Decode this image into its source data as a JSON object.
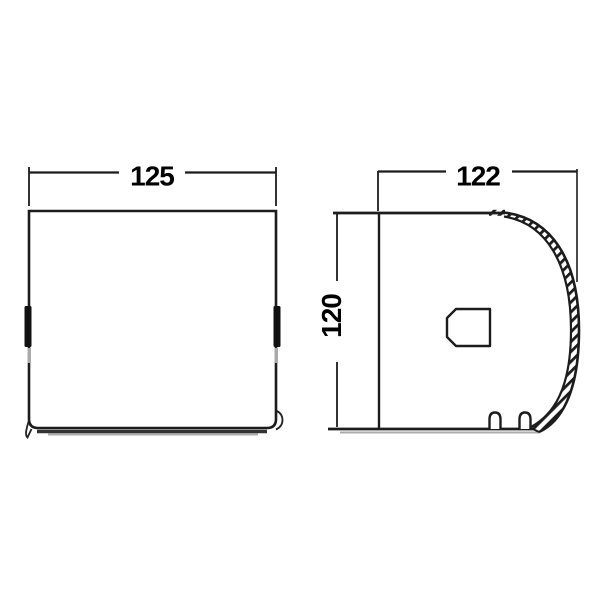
{
  "page": {
    "background": "#ffffff"
  },
  "drawing": {
    "type": "technical-dimension-drawing",
    "subject": "toilet-paper-holder",
    "views": {
      "front": {
        "name": "front-view",
        "width_dimension": {
          "value": "125"
        }
      },
      "side": {
        "name": "side-view",
        "width_dimension": {
          "value": "122"
        },
        "height_dimension": {
          "value": "120"
        }
      }
    },
    "colors": {
      "line": "#1c1c1c",
      "text": "#000000",
      "shadow": "#999999",
      "extension_faint": "#9a9a9a"
    }
  }
}
